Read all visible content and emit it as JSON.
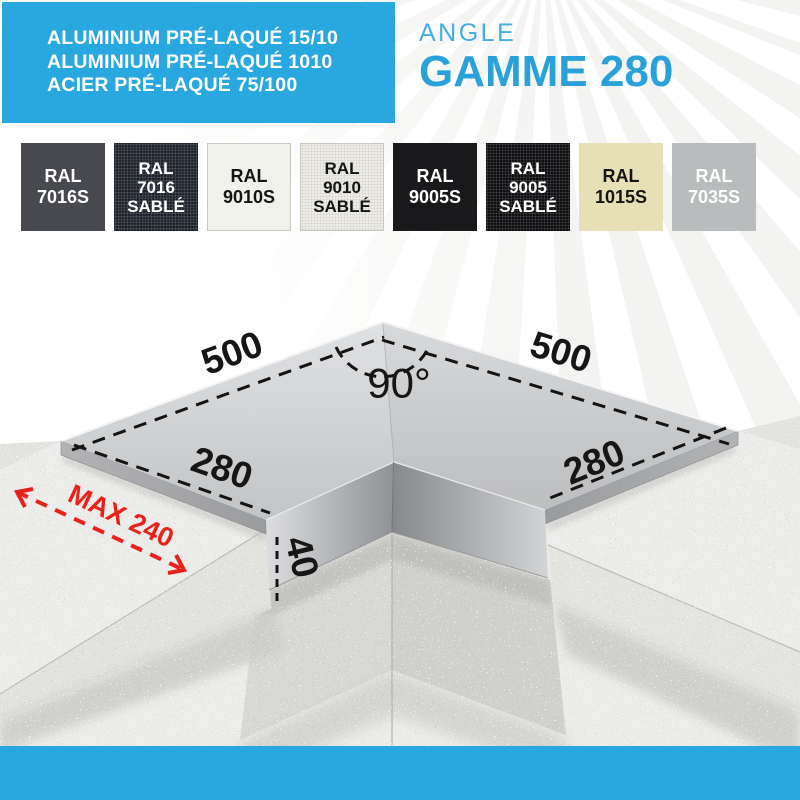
{
  "page": {
    "background_color": "#ffffff",
    "bottom_bar_color": "#29a8e0"
  },
  "banner": {
    "background_color": "#29a8e0",
    "materials": [
      "ALUMINIUM PRÉ-LAQUÉ 15/10",
      "ALUMINIUM PRÉ-LAQUÉ 1010",
      "ACIER PRÉ-LAQUÉ 75/100"
    ]
  },
  "title": {
    "line1": "ANGLE",
    "line2": "GAMME 280",
    "line1_color": "#45ade2",
    "line2_color": "#2ba1da"
  },
  "swatches": [
    {
      "lines": [
        "RAL",
        "7016S"
      ],
      "hex": "#47494e",
      "text_color": "#ffffff",
      "textured": false
    },
    {
      "lines": [
        "RAL",
        "7016",
        "SABLÉ"
      ],
      "hex": "#232831",
      "text_color": "#ffffff",
      "textured": true
    },
    {
      "lines": [
        "RAL",
        "9010S"
      ],
      "hex": "#f1f1eb",
      "text_color": "#141414",
      "textured": false,
      "border": "#c9c9c3"
    },
    {
      "lines": [
        "RAL",
        "9010",
        "SABLÉ"
      ],
      "hex": "#edece6",
      "text_color": "#141414",
      "textured": true,
      "border": "#c9c9c3"
    },
    {
      "lines": [
        "RAL",
        "9005S"
      ],
      "hex": "#19181a",
      "text_color": "#ffffff",
      "textured": false
    },
    {
      "lines": [
        "RAL",
        "9005",
        "SABLÉ"
      ],
      "hex": "#111114",
      "text_color": "#ffffff",
      "textured": true
    },
    {
      "lines": [
        "RAL",
        "1015S"
      ],
      "hex": "#e7dfb5",
      "text_color": "#141414",
      "textured": false
    },
    {
      "lines": [
        "RAL",
        "7035S"
      ],
      "hex": "#b9bcbd",
      "text_color": "#ffffff",
      "textured": false
    }
  ],
  "diagram": {
    "labels": {
      "arm_left": "500",
      "arm_right": "500",
      "angle": "90°",
      "width_left": "280",
      "width_right": "280",
      "drop_height": "40",
      "max_wall": "MAX 240"
    },
    "dimension_color": "#161616",
    "max_color": "#e8211b"
  }
}
